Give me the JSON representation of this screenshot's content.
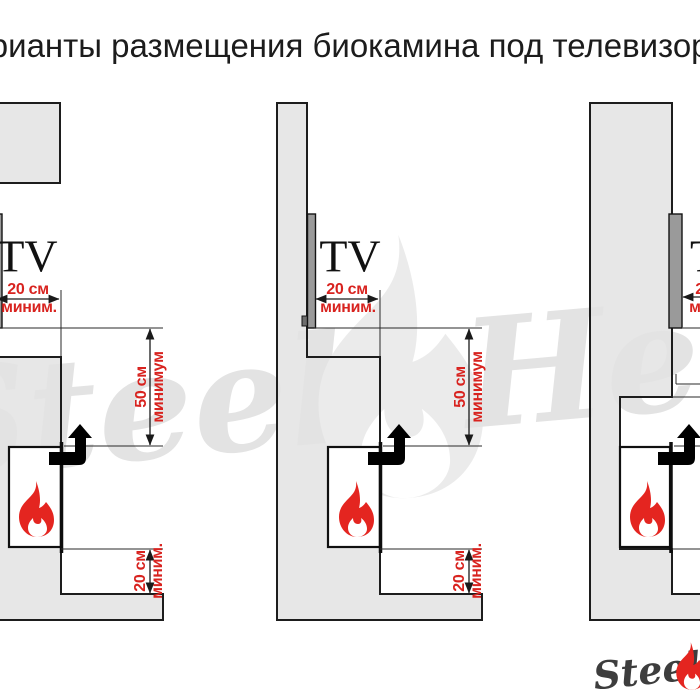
{
  "title": "Варианты размещения биокамина под телевизором",
  "labels": {
    "tv": "TV",
    "dist_front": {
      "value": "20 см",
      "qualifier": "миним."
    },
    "dist_above": {
      "value": "50 см",
      "qualifier": "минимум"
    },
    "dist_below": {
      "value": "20 см",
      "qualifier": "миним."
    }
  },
  "watermark": {
    "word1": "Steel",
    "word2": "Heat"
  },
  "logo": {
    "brand": "Steel"
  },
  "icons": {
    "flame": "flame-icon",
    "airflow": "elbow-up-arrow-icon"
  },
  "colors": {
    "dimension_red": "#d8231f",
    "flame_red": "#e42520",
    "arrow_orange": "#f0a42e",
    "arrow_outline": "#c9861c",
    "wall_gray": "#e7e7e7",
    "line_dark": "#1d1d1d",
    "watermark_gray": "#e3e3e3",
    "logo_gray": "#3d3d3d",
    "title_color": "#1c1c1c",
    "tv_gray": "#9a9a9a"
  }
}
